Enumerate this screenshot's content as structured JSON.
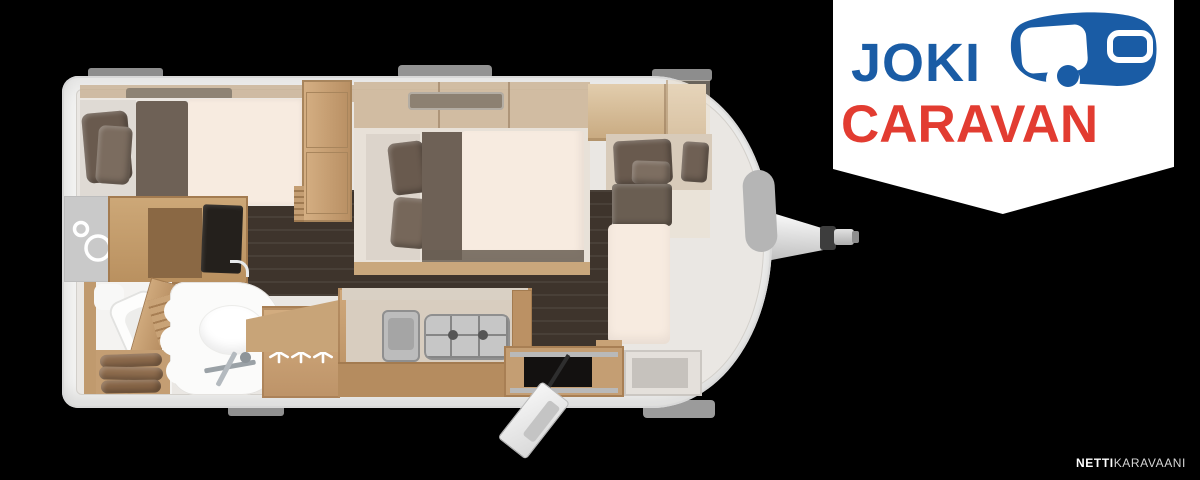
{
  "logo": {
    "line1": "JOKI",
    "line2": "CARAVAN",
    "blue": "#1a5ca5",
    "red": "#e23c31",
    "icon": "caravan-icon"
  },
  "watermark": {
    "bold": "NETTI",
    "light": "KARAVAANI"
  },
  "floorplan": {
    "type": "caravan-floor-plan-top-view",
    "stars": "***",
    "colors": {
      "background": "#000000",
      "body_shell": "#f2f2f1",
      "interior": "#eae7e3",
      "floor": "#3e342c",
      "wood": "#c49e73",
      "mattress": "#f7ebe0",
      "cushions": "#695a4e",
      "metal": "#c6c6c6"
    },
    "elements": [
      "rear-double-bed",
      "wardrobe",
      "shower",
      "toilet",
      "washbasin",
      "tv",
      "kitchen-sink",
      "gas-hob",
      "fridge-cabinet",
      "entry-door-open",
      "front-bed",
      "dinette-cushions",
      "tow-hitch"
    ]
  }
}
